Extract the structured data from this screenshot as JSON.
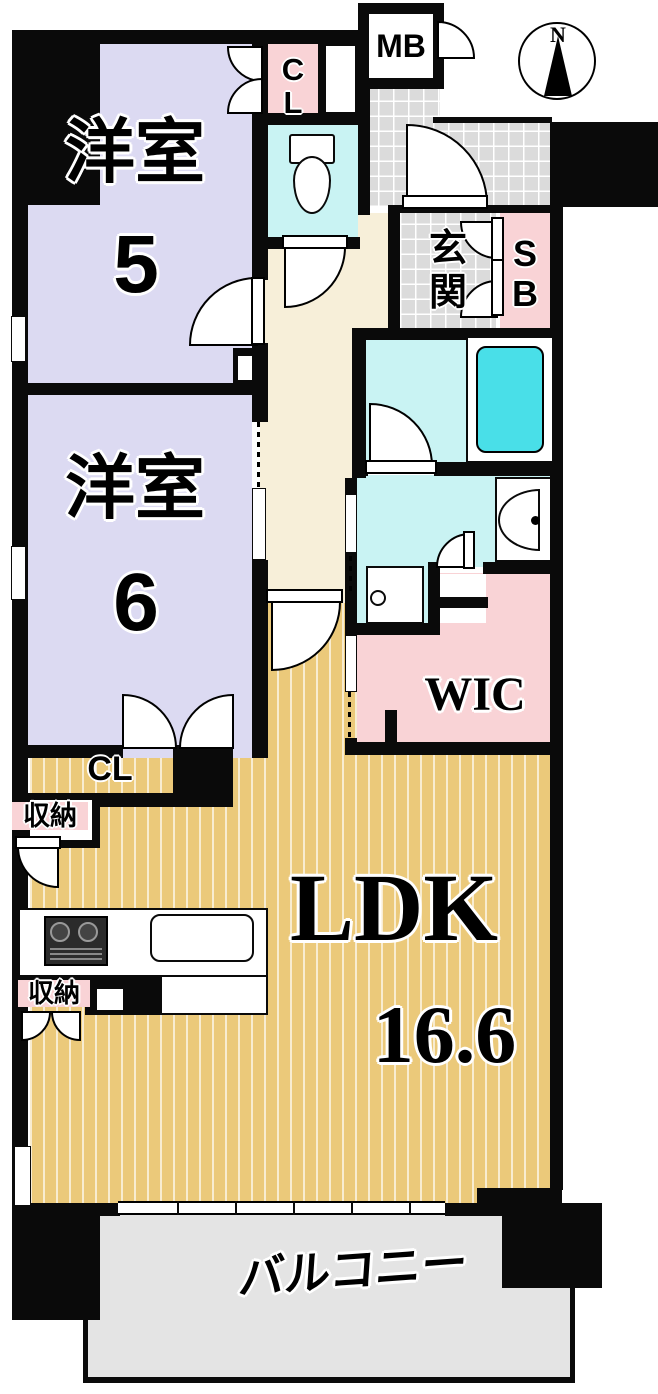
{
  "compass": {
    "north_label": "N"
  },
  "rooms": {
    "western_room_5": {
      "name": "洋室",
      "size": "5"
    },
    "western_room_6": {
      "name": "洋室",
      "size": "6"
    },
    "ldk": {
      "name": "LDK",
      "size": "16.6"
    },
    "balcony": {
      "name": "バルコニー"
    },
    "entrance": {
      "name": "玄関"
    },
    "wic": {
      "name": "WIC"
    },
    "shoe_box": {
      "name": "SB"
    },
    "closet_top": {
      "name": "CL"
    },
    "closet_mid": {
      "name": "CL"
    },
    "meter_box": {
      "name": "MB"
    },
    "storage_1": {
      "name": "収納"
    },
    "storage_2": {
      "name": "収納"
    }
  },
  "colors": {
    "wall": "#0a0a0a",
    "western_room": "#dcdaf2",
    "ldk_floor": "#ebc97a",
    "wet_area": "#c9f3f3",
    "bathtub": "#49dfe8",
    "closet_pink": "#f9d3d6",
    "hallway": "#f7efd9",
    "entrance_tile": "#dbdbdb",
    "balcony": "#e4e4e4"
  }
}
